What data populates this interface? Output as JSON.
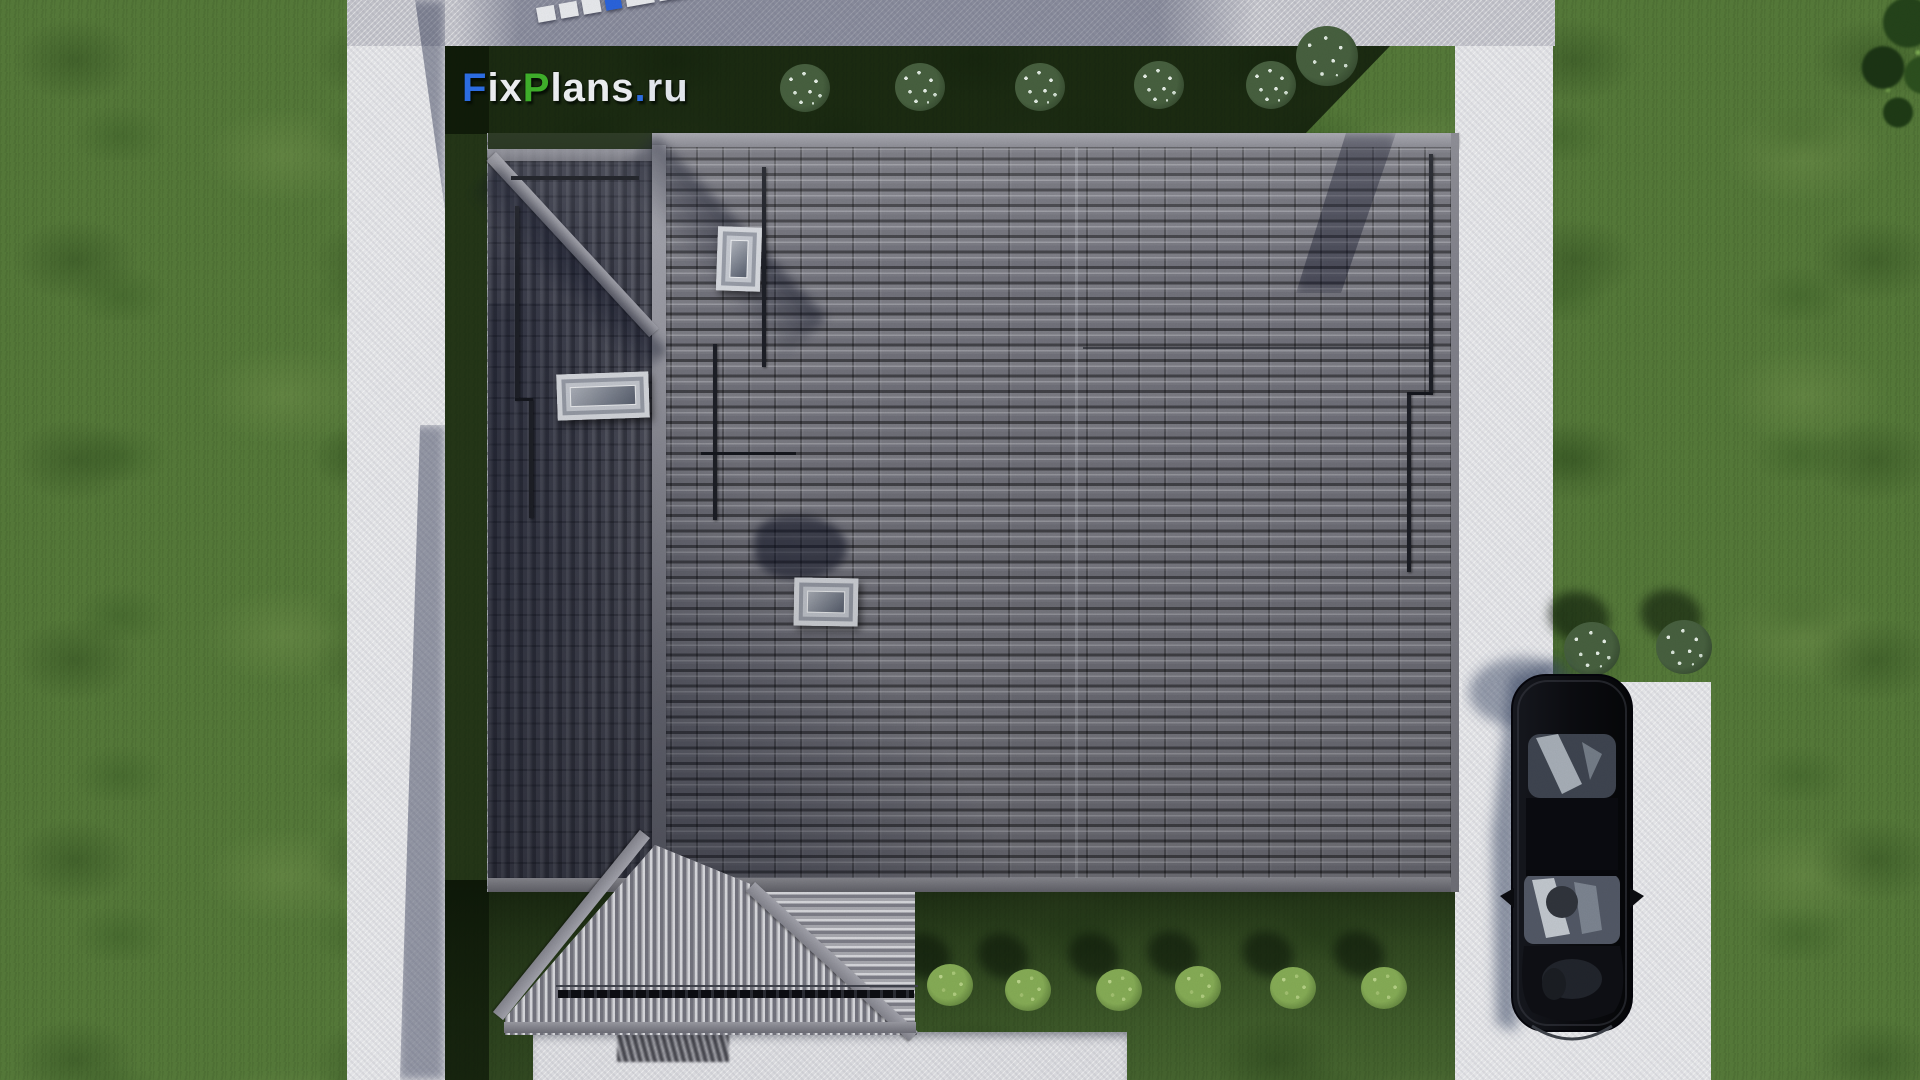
{
  "scene": {
    "view": "top-down 3D architectural site render",
    "watermark_logo": "FixPlans.ru"
  },
  "logo": {
    "parts": [
      {
        "text": "F",
        "color": "#2d6fe8"
      },
      {
        "text": "ix",
        "color": "#f0f1f6"
      },
      {
        "text": "P",
        "color": "#3fb12b"
      },
      {
        "text": "lans",
        "color": "#f0f1f6"
      },
      {
        "text": ".",
        "color": "#2d6fe8"
      },
      {
        "text": "ru",
        "color": "#e6eaf2"
      }
    ]
  },
  "palette": {
    "lawn": "#567a3a",
    "lawn_shaded": "#16270e",
    "path_white": "#e8e8ed",
    "path_top_gray": "#c2c2cb",
    "roof_tiles": "#73737d",
    "roof_ridge": "#8f8f99",
    "porch_tiles": "#c7c7cf",
    "car_body": "#0d0e12",
    "car_shadow": "#333f5e",
    "bush_flowers": "#e3ebe4",
    "bush_green": "#86ac56"
  },
  "inventory": {
    "flowering_bushes_top_row": 6,
    "flowering_bushes_right": 2,
    "green_bushes_bottom_row": 6,
    "roof_skylights": 3,
    "parked_cars": 1,
    "corner_trees": 1
  }
}
